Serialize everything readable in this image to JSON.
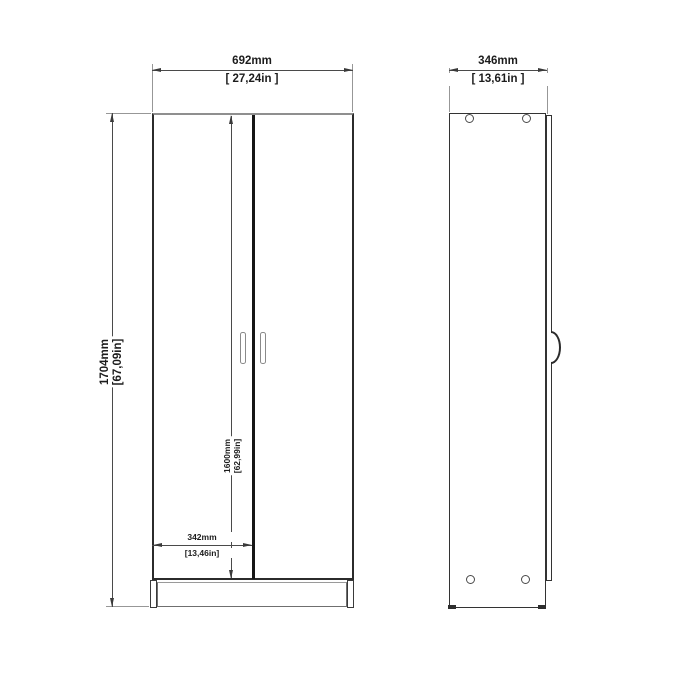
{
  "title": "Wardrobe technical dimension drawing, front and side views",
  "views": {
    "front": {
      "overall_width": {
        "mm": "692mm",
        "inches": "[ 27,24in ]"
      },
      "overall_height": {
        "mm": "1704mm",
        "inches": "[67,09in]"
      },
      "door_height": {
        "mm": "1600mm",
        "inches": "[62,99in]"
      },
      "door_width": {
        "mm": "342mm",
        "inches": "[13,46in]"
      }
    },
    "side": {
      "depth": {
        "mm": "346mm",
        "inches": "[ 13,61in ]"
      }
    }
  },
  "colors": {
    "background": "#ffffff",
    "line_dark": "#2b2b2b",
    "line_mid": "#4a4a4a",
    "line_light": "#979797"
  }
}
